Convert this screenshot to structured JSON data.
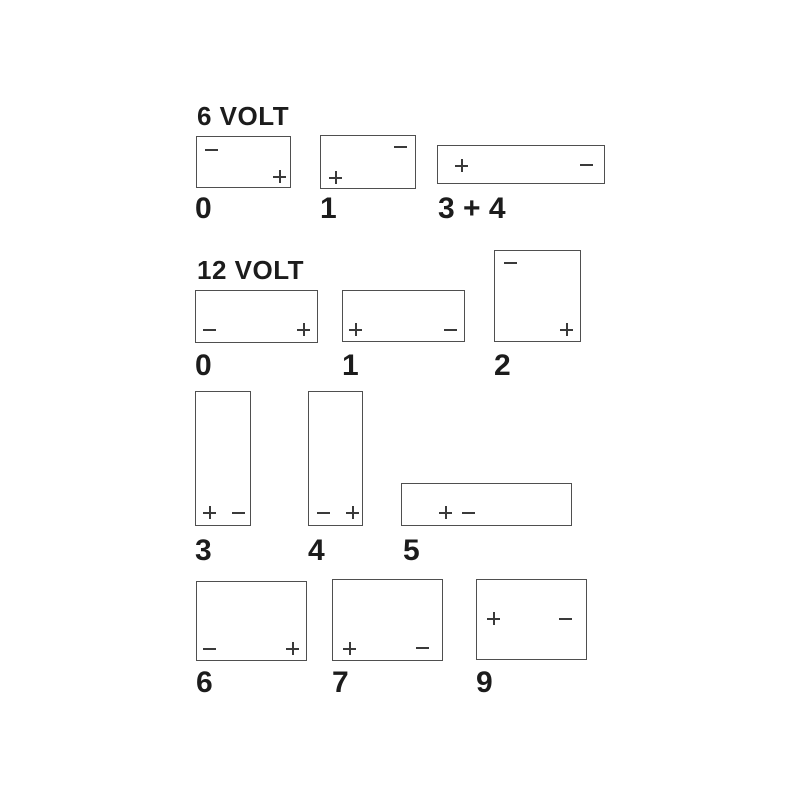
{
  "colors": {
    "background": "#ffffff",
    "box_border": "#4f4f4f",
    "terminal": "#3a3a3a",
    "label": "#1c1c1c"
  },
  "symbols": {
    "plus": "+",
    "minus": "−"
  },
  "sections": [
    {
      "heading": "6 VOLT",
      "heading_pos": {
        "x": 197,
        "y": 103
      },
      "batteries": [
        {
          "label": "0",
          "box": {
            "x": 196,
            "y": 136,
            "w": 95,
            "h": 52
          },
          "label_pos": {
            "x": 195,
            "y": 194
          },
          "terminals": [
            {
              "sign": "minus",
              "x": 8,
              "y": 6
            },
            {
              "sign": "plus",
              "x": 76,
              "y": 33
            }
          ]
        },
        {
          "label": "1",
          "box": {
            "x": 320,
            "y": 135,
            "w": 96,
            "h": 54
          },
          "label_pos": {
            "x": 320,
            "y": 194
          },
          "terminals": [
            {
              "sign": "minus",
              "x": 73,
              "y": 4
            },
            {
              "sign": "plus",
              "x": 8,
              "y": 35
            }
          ]
        },
        {
          "label": "3 + 4",
          "box": {
            "x": 437,
            "y": 145,
            "w": 168,
            "h": 39
          },
          "label_pos": {
            "x": 438,
            "y": 194
          },
          "terminals": [
            {
              "sign": "plus",
              "x": 17,
              "y": 13
            },
            {
              "sign": "minus",
              "x": 142,
              "y": 12
            }
          ]
        }
      ]
    },
    {
      "heading": "12 VOLT",
      "heading_pos": {
        "x": 197,
        "y": 257
      },
      "batteries": [
        {
          "label": "0",
          "box": {
            "x": 195,
            "y": 290,
            "w": 123,
            "h": 53
          },
          "label_pos": {
            "x": 195,
            "y": 351
          },
          "terminals": [
            {
              "sign": "minus",
              "x": 7,
              "y": 32
            },
            {
              "sign": "plus",
              "x": 101,
              "y": 32
            }
          ]
        },
        {
          "label": "1",
          "box": {
            "x": 342,
            "y": 290,
            "w": 123,
            "h": 52
          },
          "label_pos": {
            "x": 342,
            "y": 351
          },
          "terminals": [
            {
              "sign": "plus",
              "x": 6,
              "y": 32
            },
            {
              "sign": "minus",
              "x": 101,
              "y": 32
            }
          ]
        },
        {
          "label": "2",
          "box": {
            "x": 494,
            "y": 250,
            "w": 87,
            "h": 92
          },
          "label_pos": {
            "x": 494,
            "y": 351
          },
          "terminals": [
            {
              "sign": "minus",
              "x": 9,
              "y": 5
            },
            {
              "sign": "plus",
              "x": 65,
              "y": 72
            }
          ]
        },
        {
          "label": "3",
          "box": {
            "x": 195,
            "y": 391,
            "w": 56,
            "h": 135
          },
          "label_pos": {
            "x": 195,
            "y": 536
          },
          "terminals": [
            {
              "sign": "plus",
              "x": 7,
              "y": 114
            },
            {
              "sign": "minus",
              "x": 36,
              "y": 114
            }
          ]
        },
        {
          "label": "4",
          "box": {
            "x": 308,
            "y": 391,
            "w": 55,
            "h": 135
          },
          "label_pos": {
            "x": 308,
            "y": 536
          },
          "terminals": [
            {
              "sign": "minus",
              "x": 8,
              "y": 114
            },
            {
              "sign": "plus",
              "x": 37,
              "y": 114
            }
          ]
        },
        {
          "label": "5",
          "box": {
            "x": 401,
            "y": 483,
            "w": 171,
            "h": 43
          },
          "label_pos": {
            "x": 403,
            "y": 536
          },
          "terminals": [
            {
              "sign": "plus",
              "x": 37,
              "y": 22
            },
            {
              "sign": "minus",
              "x": 60,
              "y": 22
            }
          ]
        },
        {
          "label": "6",
          "box": {
            "x": 196,
            "y": 581,
            "w": 111,
            "h": 80
          },
          "label_pos": {
            "x": 196,
            "y": 668
          },
          "terminals": [
            {
              "sign": "minus",
              "x": 6,
              "y": 60
            },
            {
              "sign": "plus",
              "x": 89,
              "y": 60
            }
          ]
        },
        {
          "label": "7",
          "box": {
            "x": 332,
            "y": 579,
            "w": 111,
            "h": 82
          },
          "label_pos": {
            "x": 332,
            "y": 668
          },
          "terminals": [
            {
              "sign": "plus",
              "x": 10,
              "y": 62
            },
            {
              "sign": "minus",
              "x": 83,
              "y": 61
            }
          ]
        },
        {
          "label": "9",
          "box": {
            "x": 476,
            "y": 579,
            "w": 111,
            "h": 81
          },
          "label_pos": {
            "x": 476,
            "y": 668
          },
          "terminals": [
            {
              "sign": "plus",
              "x": 10,
              "y": 32
            },
            {
              "sign": "minus",
              "x": 82,
              "y": 32
            }
          ]
        }
      ]
    }
  ]
}
